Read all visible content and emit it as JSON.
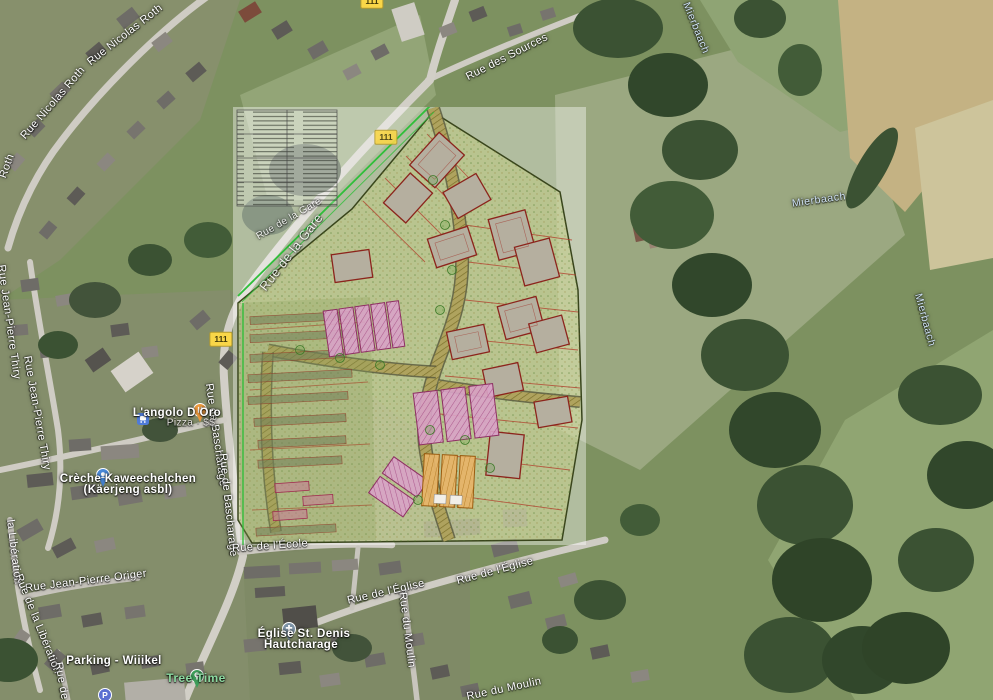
{
  "map": {
    "streets": {
      "rue_nicolas_roth_1": "Rue Nicolas Roth",
      "rue_nicolas_roth_2": "Rue Nicolas Roth",
      "rue_nicolas_roth_3": "Roth",
      "rue_des_sources": "Rue des Sources",
      "rue_de_la_gare_1": "Rue de la Gare",
      "rue_de_la_gare_2": "Rue de la Gare",
      "rue_jean_pierre_thiry_1": "Rue Jean-Pierre Thiry",
      "rue_jean_pierre_thiry_2": "Rue Jean-Pierre Thiry",
      "rue_de_bascharage_1": "Rue de Bascharage",
      "rue_de_bascharage_2": "Rue de Bascharage",
      "rue_jean_pierre_origer": "Rue Jean-Pierre Origer",
      "rue_de_la_liberation_1": "la Libération",
      "rue_de_la_liberation_2": "Rue de la Libération",
      "rue_de_l_ecole": "Rue de l'École",
      "rue_de_l_eglise_1": "Rue de l'Église",
      "rue_de_l_eglise_2": "Rue de l'Église",
      "rue_du_moulin_1": "Rue du Moulin",
      "rue_du_moulin_2": "Rue du Moulin",
      "rue_de_l_partial": "Rue de l"
    },
    "water": {
      "label_1": "Mierbaach",
      "label_2": "Mierbaach",
      "label_3": "Mierbaach"
    },
    "route_badge": {
      "text": "111"
    },
    "pois": {
      "restaurant": {
        "name": "L'angolo D Oro",
        "subtitle": "Pizza · $$"
      },
      "creche": {
        "line1": "Crèche Kaweechelchen",
        "line2": "(Käerjeng asbl)"
      },
      "parking": {
        "name": "Parking - Wiiikel"
      },
      "tree_time": {
        "name": "Tree Time"
      },
      "church": {
        "line1": "Église St. Denis",
        "line2": "Hautcharage"
      }
    },
    "colors": {
      "route_badge_bg": "#f9d648",
      "plan_parcel_tint": "#c8d17a",
      "plan_building_fill": "#b5af9f",
      "plan_building_stroke": "#8c241c",
      "plan_pink": "#d9a3c8",
      "plan_orange": "#e7b468",
      "plan_boundary_green": "#2fbf3a",
      "field_tan": "#c4b283",
      "forest_green": "#3b5233"
    }
  }
}
